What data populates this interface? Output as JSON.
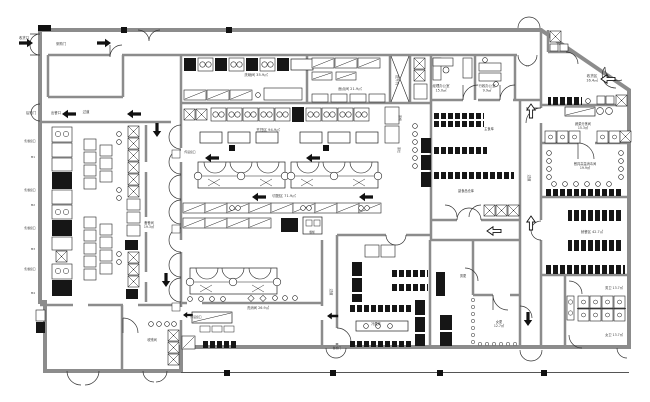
{
  "drawing": {
    "type": "cad-floor-plan",
    "description": "厨房平面布置图",
    "colors": {
      "background": "#ffffff",
      "wall": "#8c8c8c",
      "line": "#1f1f1f",
      "equipment_dark": "#161616",
      "label": "#3a3a3a"
    }
  },
  "labels": [
    {
      "t": "收货口",
      "x": 24,
      "y": 39,
      "s": 3.4
    },
    {
      "t": "采购门",
      "x": 61,
      "y": 45,
      "s": 3.4
    },
    {
      "t": "后勤门",
      "x": 31,
      "y": 114,
      "s": 3.4
    },
    {
      "t": "出餐口",
      "x": 56,
      "y": 114,
      "s": 3.4
    },
    {
      "t": "过道",
      "x": 86,
      "y": 113,
      "s": 3.4
    },
    {
      "t": "售餐窗口",
      "x": 30,
      "y": 142,
      "s": 2.8
    },
    {
      "t": "M1",
      "x": 33,
      "y": 158,
      "s": 2.8
    },
    {
      "t": "售餐窗口",
      "x": 30,
      "y": 191,
      "s": 2.8
    },
    {
      "t": "M2",
      "x": 33,
      "y": 206,
      "s": 2.8
    },
    {
      "t": "售餐窗口",
      "x": 30,
      "y": 229,
      "s": 2.8
    },
    {
      "t": "M3",
      "x": 33,
      "y": 250,
      "s": 2.8
    },
    {
      "t": "售餐窗口",
      "x": 30,
      "y": 270,
      "s": 2.8
    },
    {
      "t": "M4",
      "x": 33,
      "y": 294,
      "s": 2.8
    },
    {
      "t": "洗碗间 35.9㎡",
      "x": 256,
      "y": 76,
      "s": 3.6
    },
    {
      "t": "面点间 21.9㎡",
      "x": 350,
      "y": 90,
      "s": 3.6
    },
    {
      "t": "提升机",
      "x": 396,
      "y": 80,
      "s": 3.2,
      "r": 90
    },
    {
      "t": "经理办公室\n15.0㎡",
      "x": 441,
      "y": 87,
      "s": 3.4
    },
    {
      "t": "行政办公室\n9.9㎡",
      "x": 487,
      "y": 87,
      "s": 3.4
    },
    {
      "t": "收货区\n16.4㎡",
      "x": 592,
      "y": 77,
      "s": 3.6
    },
    {
      "t": "蔬菜分拣间\n15.3㎡",
      "x": 583,
      "y": 125,
      "s": 3.2
    },
    {
      "t": "餐具高温消毒间\n19.9㎡",
      "x": 585,
      "y": 165,
      "s": 3.2
    },
    {
      "t": "就餐区 42.7㎡",
      "x": 592,
      "y": 233,
      "s": 3.4
    },
    {
      "t": "过道",
      "x": 528,
      "y": 178,
      "s": 3.4,
      "r": 90
    },
    {
      "t": "过道",
      "x": 330,
      "y": 292,
      "s": 3.4,
      "r": 90
    },
    {
      "t": "烹饪区 94.9㎡",
      "x": 268,
      "y": 131,
      "s": 3.6
    },
    {
      "t": "切配区 71.9㎡",
      "x": 284,
      "y": 197,
      "s": 3.6
    },
    {
      "t": "传递窗口",
      "x": 190,
      "y": 153,
      "s": 2.8
    },
    {
      "t": "备餐间\n19.3㎡",
      "x": 149,
      "y": 224,
      "s": 3.2
    },
    {
      "t": "收残间",
      "x": 152,
      "y": 341,
      "s": 3.2
    },
    {
      "t": "传递窗口",
      "x": 196,
      "y": 318,
      "s": 2.8
    },
    {
      "t": "洗消间 26.9㎡",
      "x": 258,
      "y": 309,
      "s": 3.4
    },
    {
      "t": "冷藏库",
      "x": 376,
      "y": 325,
      "s": 3.2
    },
    {
      "t": "女更\n12.7㎡",
      "x": 499,
      "y": 323,
      "s": 3.2
    },
    {
      "t": "男更",
      "x": 463,
      "y": 277,
      "s": 3.2
    },
    {
      "t": "男卫 13.7㎡",
      "x": 614,
      "y": 289,
      "s": 3.2
    },
    {
      "t": "女卫 13.7㎡",
      "x": 614,
      "y": 336,
      "s": 3.2
    },
    {
      "t": "主食库",
      "x": 489,
      "y": 130,
      "s": 3.2
    },
    {
      "t": "副食品仓库",
      "x": 466,
      "y": 192,
      "s": 3.2
    },
    {
      "t": "蒸柜",
      "x": 399,
      "y": 118,
      "s": 3.0,
      "r": 90
    },
    {
      "t": "蒸灶",
      "x": 398,
      "y": 150,
      "s": 3.0,
      "r": 90
    },
    {
      "t": "餐梯门",
      "x": 337,
      "y": 349,
      "s": 2.8
    },
    {
      "t": "餐梯",
      "x": 312,
      "y": 233,
      "s": 2.8
    }
  ],
  "arrows": [
    {
      "x": 33,
      "y": 43,
      "a": 180,
      "style": "filled"
    },
    {
      "x": 111,
      "y": 43,
      "a": 180,
      "style": "filled"
    },
    {
      "x": 62,
      "y": 114,
      "a": 0,
      "style": "filled"
    },
    {
      "x": 127,
      "y": 114,
      "a": 0,
      "style": "filled"
    },
    {
      "x": 205,
      "y": 158,
      "a": 0,
      "style": "filled"
    },
    {
      "x": 306,
      "y": 158,
      "a": 0,
      "style": "filled"
    },
    {
      "x": 252,
      "y": 197,
      "a": 0,
      "style": "filled"
    },
    {
      "x": 359,
      "y": 197,
      "a": 0,
      "style": "filled"
    },
    {
      "x": 183,
      "y": 315,
      "a": 0,
      "style": "filled",
      "sc": 0.7
    },
    {
      "x": 327,
      "y": 316,
      "a": 0,
      "style": "filled",
      "sc": 0.8
    },
    {
      "x": 157,
      "y": 137,
      "a": 90,
      "style": "filled"
    },
    {
      "x": 166,
      "y": 287,
      "a": 90,
      "style": "filled"
    },
    {
      "x": 528,
      "y": 326,
      "a": 90,
      "style": "filled"
    },
    {
      "x": 487,
      "y": 231,
      "a": 0,
      "style": "outline"
    },
    {
      "x": 601,
      "y": 79,
      "a": 0,
      "style": "outline"
    },
    {
      "x": 531,
      "y": 104,
      "a": 270,
      "style": "outline"
    },
    {
      "x": 531,
      "y": 216,
      "a": 270,
      "style": "outline"
    }
  ],
  "columns": [
    [
      121,
      27
    ],
    [
      226,
      27
    ],
    [
      224,
      370
    ],
    [
      330,
      370
    ],
    [
      437,
      370
    ],
    [
      541,
      370
    ],
    [
      229,
      145
    ],
    [
      323,
      145
    ]
  ]
}
